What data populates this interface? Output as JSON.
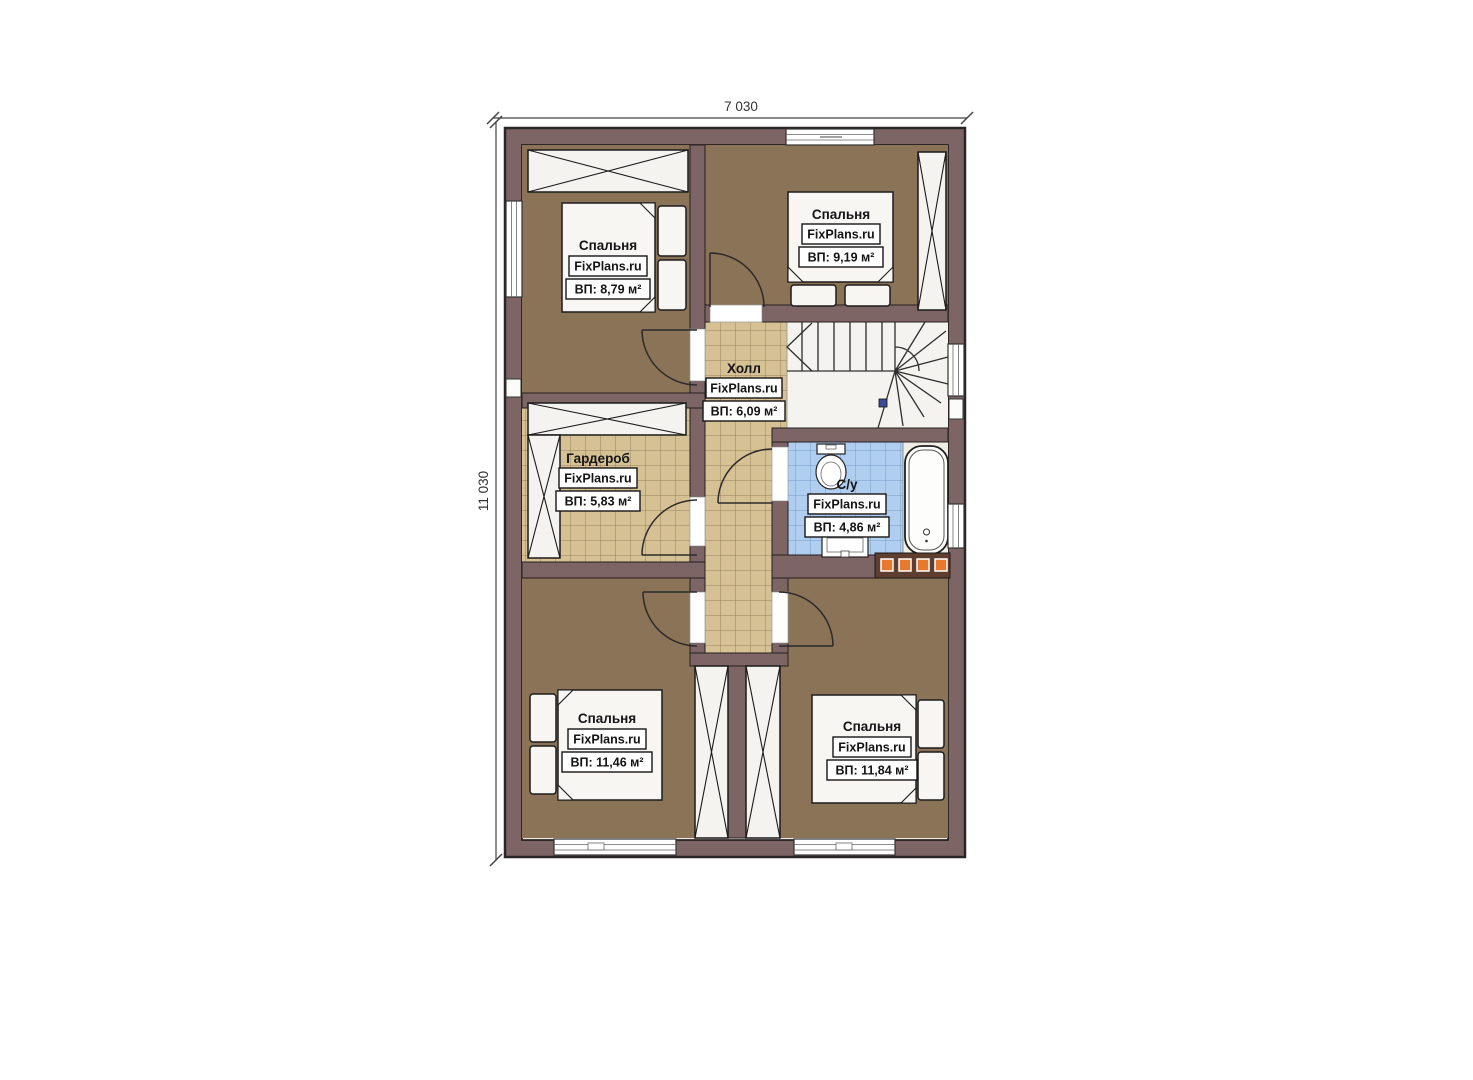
{
  "dimensions": {
    "width_label": "7 030",
    "height_label": "11 030"
  },
  "rooms": [
    {
      "id": "bedroom-top-left",
      "name": "Спальня",
      "brand": "FixPlans.ru",
      "area": "ВП: 8,79 м²"
    },
    {
      "id": "bedroom-top-right",
      "name": "Спальня",
      "brand": "FixPlans.ru",
      "area": "ВП: 9,19 м²"
    },
    {
      "id": "hall",
      "name": "Холл",
      "brand": "FixPlans.ru",
      "area": "ВП: 6,09 м²"
    },
    {
      "id": "wardrobe",
      "name": "Гардероб",
      "brand": "FixPlans.ru",
      "area": "ВП: 5,83 м²"
    },
    {
      "id": "bathroom",
      "name": "С/у",
      "brand": "FixPlans.ru",
      "area": "ВП: 4,86 м²"
    },
    {
      "id": "bedroom-bottom-left",
      "name": "Спальня",
      "brand": "FixPlans.ru",
      "area": "ВП: 11,46 м²"
    },
    {
      "id": "bedroom-bottom-right",
      "name": "Спальня",
      "brand": "FixPlans.ru",
      "area": "ВП: 11,84 м²"
    }
  ],
  "colors": {
    "wall": "#7d6565",
    "bedroom_floor": "#8c7358",
    "tile_beige": "#d6c194",
    "tile_blue": "#b0cff0",
    "radiator_strip": "#5f3e2f",
    "radiator_accent": "#e8782d",
    "stair_marker": "#3c4c94"
  }
}
